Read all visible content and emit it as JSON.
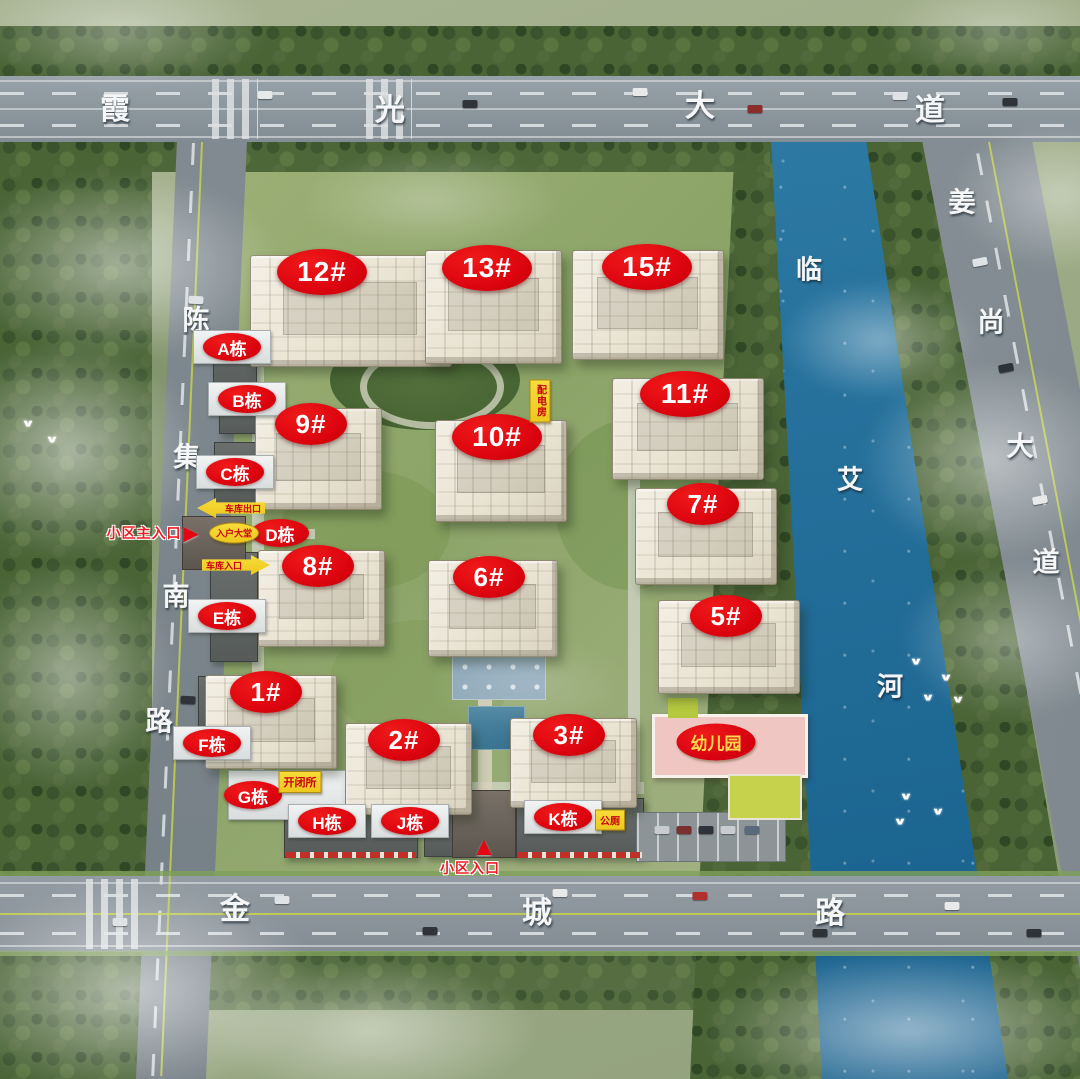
{
  "colors": {
    "label_red": "#e30613",
    "label_yellow": "#f6d32b",
    "facility_text_red": "#c80010",
    "road_text_white": "#f4f6f7",
    "river_blue": "#26729d",
    "kindergarten_pink": "#efc6c2"
  },
  "icons": {
    "arrow_right": "►",
    "arrow_up": "▲",
    "bird": "∨"
  },
  "roads": {
    "top": {
      "name": "霞光大道",
      "chars": [
        {
          "ch": "霞",
          "x": 115,
          "y": 106
        },
        {
          "ch": "光",
          "x": 390,
          "y": 107
        },
        {
          "ch": "大",
          "x": 700,
          "y": 103
        },
        {
          "ch": "道",
          "x": 930,
          "y": 107
        }
      ]
    },
    "left": {
      "name": "陈集南路",
      "chars": [
        {
          "ch": "陈",
          "x": 196,
          "y": 318
        },
        {
          "ch": "集",
          "x": 187,
          "y": 455
        },
        {
          "ch": "南",
          "x": 176,
          "y": 594
        },
        {
          "ch": "路",
          "x": 159,
          "y": 719
        }
      ]
    },
    "right": {
      "name": "姜尚大道",
      "chars": [
        {
          "ch": "姜",
          "x": 962,
          "y": 200
        },
        {
          "ch": "尚",
          "x": 991,
          "y": 320
        },
        {
          "ch": "大",
          "x": 1020,
          "y": 444
        },
        {
          "ch": "道",
          "x": 1046,
          "y": 560
        }
      ]
    },
    "bottom": {
      "name": "金城路",
      "chars": [
        {
          "ch": "金",
          "x": 235,
          "y": 906
        },
        {
          "ch": "城",
          "x": 537,
          "y": 910
        },
        {
          "ch": "路",
          "x": 830,
          "y": 910
        }
      ]
    },
    "river": {
      "name": "临艾河",
      "chars": [
        {
          "ch": "临",
          "x": 809,
          "y": 268
        },
        {
          "ch": "艾",
          "x": 850,
          "y": 478
        },
        {
          "ch": "河",
          "x": 890,
          "y": 685
        }
      ]
    }
  },
  "buildings": [
    {
      "text": "12#",
      "lx": 322,
      "ly": 272,
      "bx": 250,
      "by": 255,
      "bw": 200,
      "bh": 110
    },
    {
      "text": "13#",
      "lx": 487,
      "ly": 268,
      "bx": 425,
      "by": 250,
      "bw": 135,
      "bh": 112
    },
    {
      "text": "15#",
      "lx": 647,
      "ly": 267,
      "bx": 572,
      "by": 250,
      "bw": 150,
      "bh": 108
    },
    {
      "text": "11#",
      "lx": 685,
      "ly": 394,
      "bx": 612,
      "by": 378,
      "bw": 150,
      "bh": 100
    },
    {
      "text": "9#",
      "lx": 311,
      "ly": 424,
      "bx": 255,
      "by": 408,
      "bw": 125,
      "bh": 100
    },
    {
      "text": "10#",
      "lx": 497,
      "ly": 437,
      "bx": 435,
      "by": 420,
      "bw": 130,
      "bh": 100
    },
    {
      "text": "7#",
      "lx": 703,
      "ly": 504,
      "bx": 635,
      "by": 488,
      "bw": 140,
      "bh": 95
    },
    {
      "text": "8#",
      "lx": 318,
      "ly": 566,
      "bx": 258,
      "by": 550,
      "bw": 125,
      "bh": 95
    },
    {
      "text": "6#",
      "lx": 489,
      "ly": 577,
      "bx": 428,
      "by": 560,
      "bw": 128,
      "bh": 95
    },
    {
      "text": "5#",
      "lx": 726,
      "ly": 616,
      "bx": 658,
      "by": 600,
      "bw": 140,
      "bh": 92
    },
    {
      "text": "1#",
      "lx": 266,
      "ly": 692,
      "bx": 205,
      "by": 675,
      "bw": 130,
      "bh": 92
    },
    {
      "text": "2#",
      "lx": 404,
      "ly": 740,
      "bx": 345,
      "by": 723,
      "bw": 125,
      "bh": 90
    },
    {
      "text": "3#",
      "lx": 569,
      "ly": 735,
      "bx": 510,
      "by": 718,
      "bw": 125,
      "bh": 88
    }
  ],
  "blocks": [
    {
      "key": "a",
      "text": "A栋",
      "x": 232,
      "y": 347,
      "board": true
    },
    {
      "key": "b",
      "text": "B栋",
      "x": 247,
      "y": 399,
      "board": true
    },
    {
      "key": "c",
      "text": "C栋",
      "x": 235,
      "y": 472,
      "board": true
    },
    {
      "key": "d",
      "text": "D栋",
      "x": 280,
      "y": 533,
      "board": false
    },
    {
      "key": "e",
      "text": "E栋",
      "x": 227,
      "y": 616,
      "board": true
    },
    {
      "key": "f",
      "text": "F栋",
      "x": 212,
      "y": 743,
      "board": true
    },
    {
      "key": "g",
      "text": "G栋",
      "x": 253,
      "y": 795,
      "board": false
    },
    {
      "key": "h",
      "text": "H栋",
      "x": 327,
      "y": 821,
      "board": true
    },
    {
      "key": "j",
      "text": "J栋",
      "x": 410,
      "y": 821,
      "board": true
    },
    {
      "key": "k",
      "text": "K栋",
      "x": 563,
      "y": 817,
      "board": true
    }
  ],
  "facilities": [
    {
      "key": "kaibisuo",
      "text": "开闭所",
      "x": 300,
      "y": 782,
      "style": "rect",
      "fs": 11
    },
    {
      "key": "gongce",
      "text": "公厕",
      "x": 610,
      "y": 820,
      "style": "rect",
      "fs": 10
    },
    {
      "key": "peidianfang",
      "text": "配电房",
      "x": 540,
      "y": 401,
      "style": "vert",
      "fs": 10
    },
    {
      "key": "ruhu-dating",
      "text": "入户大堂",
      "x": 234,
      "y": 533,
      "style": "oval",
      "fs": 9
    },
    {
      "key": "cheku-chukou",
      "text": "车库出口",
      "x": 231,
      "y": 508,
      "style": "arrow-left",
      "fs": 9
    },
    {
      "key": "cheku-rukou",
      "text": "车库入口",
      "x": 236,
      "y": 565,
      "style": "arrow-right",
      "fs": 9
    },
    {
      "key": "youeryuan",
      "text": "幼儿园",
      "x": 716,
      "y": 742,
      "style": "kg",
      "fs": 17
    }
  ],
  "entrances": [
    {
      "key": "main",
      "text": "小区主入口",
      "x": 144,
      "y": 533,
      "dir": "right",
      "ax": 191,
      "ay": 533
    },
    {
      "key": "south",
      "text": "小区入口",
      "x": 470,
      "y": 868,
      "dir": "up",
      "ax": 484,
      "ay": 846
    }
  ],
  "decor": {
    "birds": [
      [
        28,
        424
      ],
      [
        52,
        440
      ],
      [
        916,
        662
      ],
      [
        946,
        678
      ],
      [
        928,
        698
      ],
      [
        958,
        700
      ],
      [
        906,
        797
      ],
      [
        938,
        812
      ],
      [
        900,
        822
      ]
    ],
    "cars": [
      [
        265,
        95,
        "#e8eaea",
        0
      ],
      [
        470,
        104,
        "#30343a",
        0
      ],
      [
        640,
        92,
        "#e8eaea",
        0
      ],
      [
        755,
        109,
        "#8a2c2c",
        0
      ],
      [
        900,
        96,
        "#dfe3e6",
        0
      ],
      [
        1010,
        102,
        "#2e3338",
        0
      ],
      [
        980,
        262,
        "#dfe3e6",
        -11
      ],
      [
        1006,
        368,
        "#2e3338",
        -11
      ],
      [
        1040,
        500,
        "#e8eaea",
        -11
      ],
      [
        196,
        300,
        "#dfe3e6",
        2
      ],
      [
        188,
        700,
        "#30343a",
        2
      ],
      [
        120,
        922,
        "#dfe3e6",
        0
      ],
      [
        282,
        900,
        "#dfe3e6",
        0
      ],
      [
        430,
        931,
        "#30343a",
        0
      ],
      [
        560,
        893,
        "#e8eaea",
        0
      ],
      [
        700,
        896,
        "#b03030",
        0
      ],
      [
        820,
        933,
        "#2e3338",
        0
      ],
      [
        952,
        906,
        "#e8eaea",
        0
      ],
      [
        1034,
        933,
        "#2e3338",
        0
      ],
      [
        662,
        830,
        "#c8ccd0",
        0
      ],
      [
        684,
        830,
        "#7a3030",
        0
      ],
      [
        706,
        830,
        "#30343a",
        0
      ],
      [
        728,
        830,
        "#c8ccd0",
        0
      ],
      [
        752,
        830,
        "#5a6a7a",
        0
      ]
    ]
  }
}
